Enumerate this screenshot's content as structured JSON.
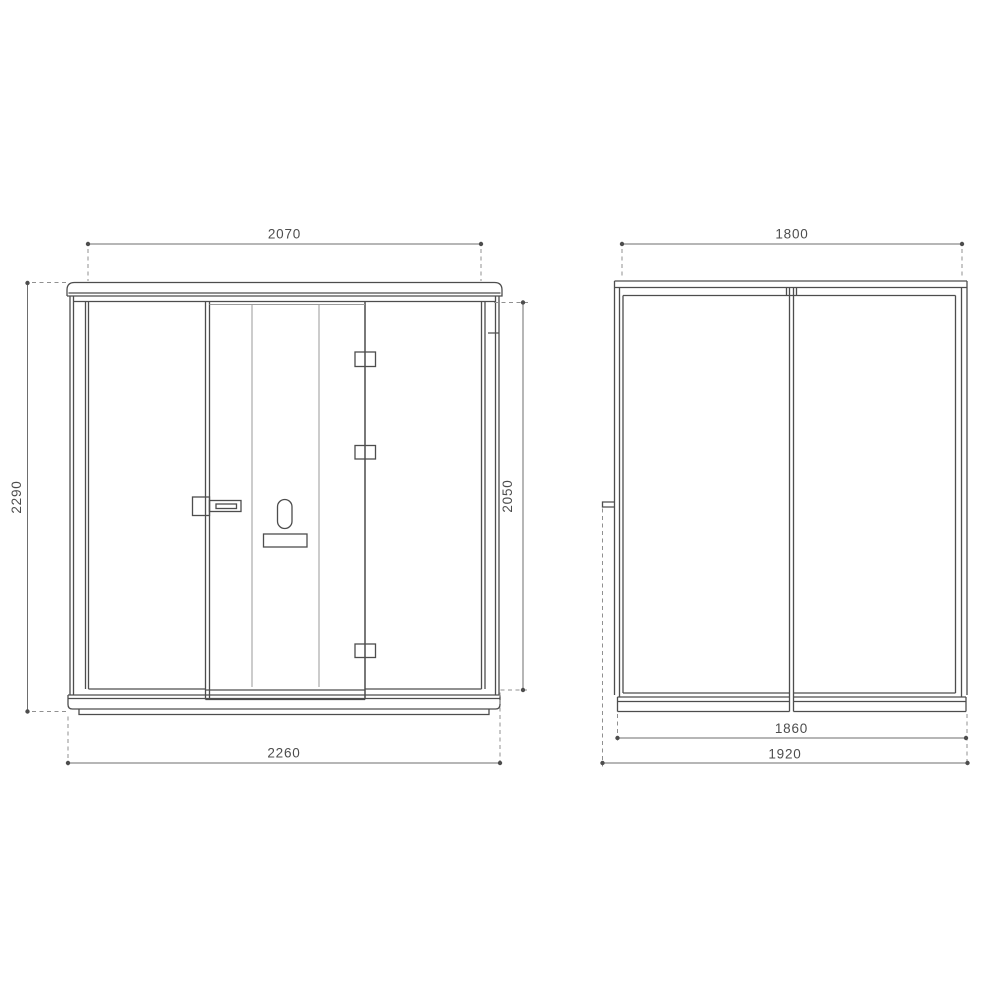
{
  "drawing": {
    "type": "technical-dimension-drawing",
    "subject": "booth-pod-elevation-views",
    "views": {
      "front": {
        "dims": {
          "top_width": "2070",
          "left_height": "2290",
          "right_height": "2050",
          "bottom_width": "2260"
        }
      },
      "side": {
        "dims": {
          "top_depth": "1800",
          "bottom_inner_depth": "1860",
          "bottom_outer_depth": "1920"
        }
      }
    },
    "colors": {
      "outline": "#4d4d4d",
      "light_line": "#9a9a9a",
      "dimension_line": "#6e6e6e",
      "dashed_line": "#909090",
      "text": "#4d4d4d",
      "background": "#ffffff"
    }
  }
}
